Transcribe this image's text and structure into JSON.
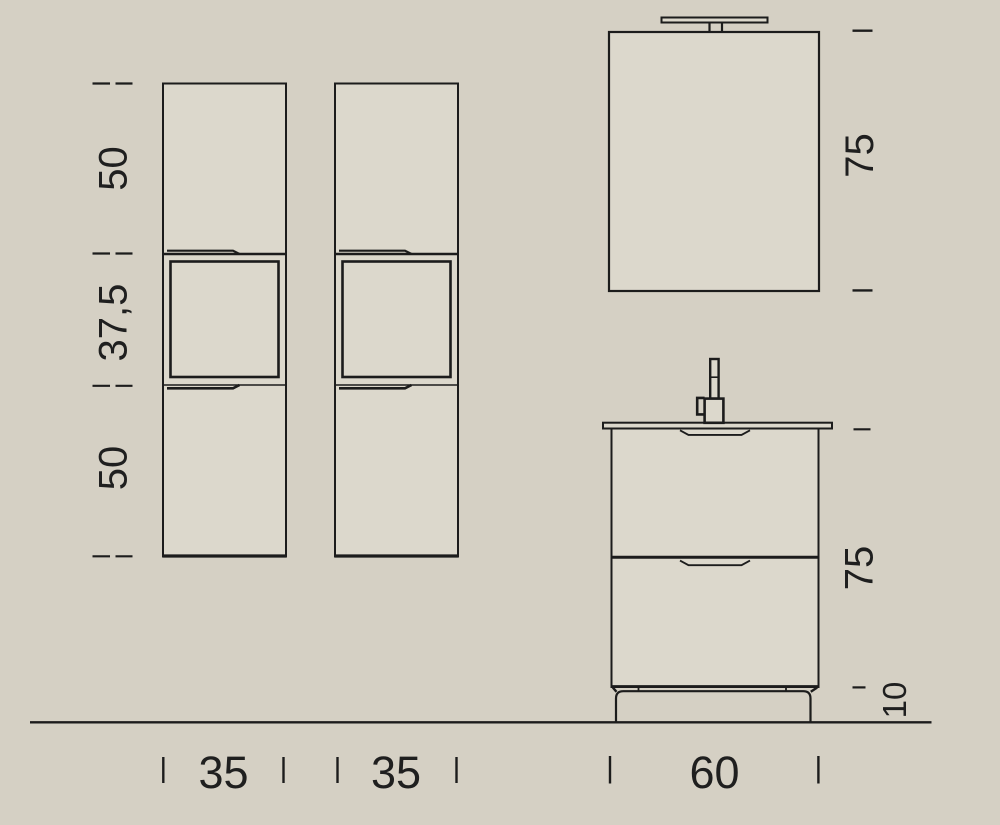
{
  "drawing": {
    "type": "bathroom-furniture-dimension-drawing",
    "units": "cm"
  },
  "colors": {
    "background": "#d5d0c4",
    "surface": "#dcd8cc",
    "line": "#1c1c1c",
    "text": "#1f1f1f"
  },
  "labels": {
    "column_section_top": "50",
    "column_section_middle": "37,5",
    "column_section_bottom": "50",
    "column1_width": "35",
    "column2_width": "35",
    "mirror_height": "75",
    "vanity_height": "75",
    "vanity_feet_height": "10",
    "vanity_width": "60"
  }
}
